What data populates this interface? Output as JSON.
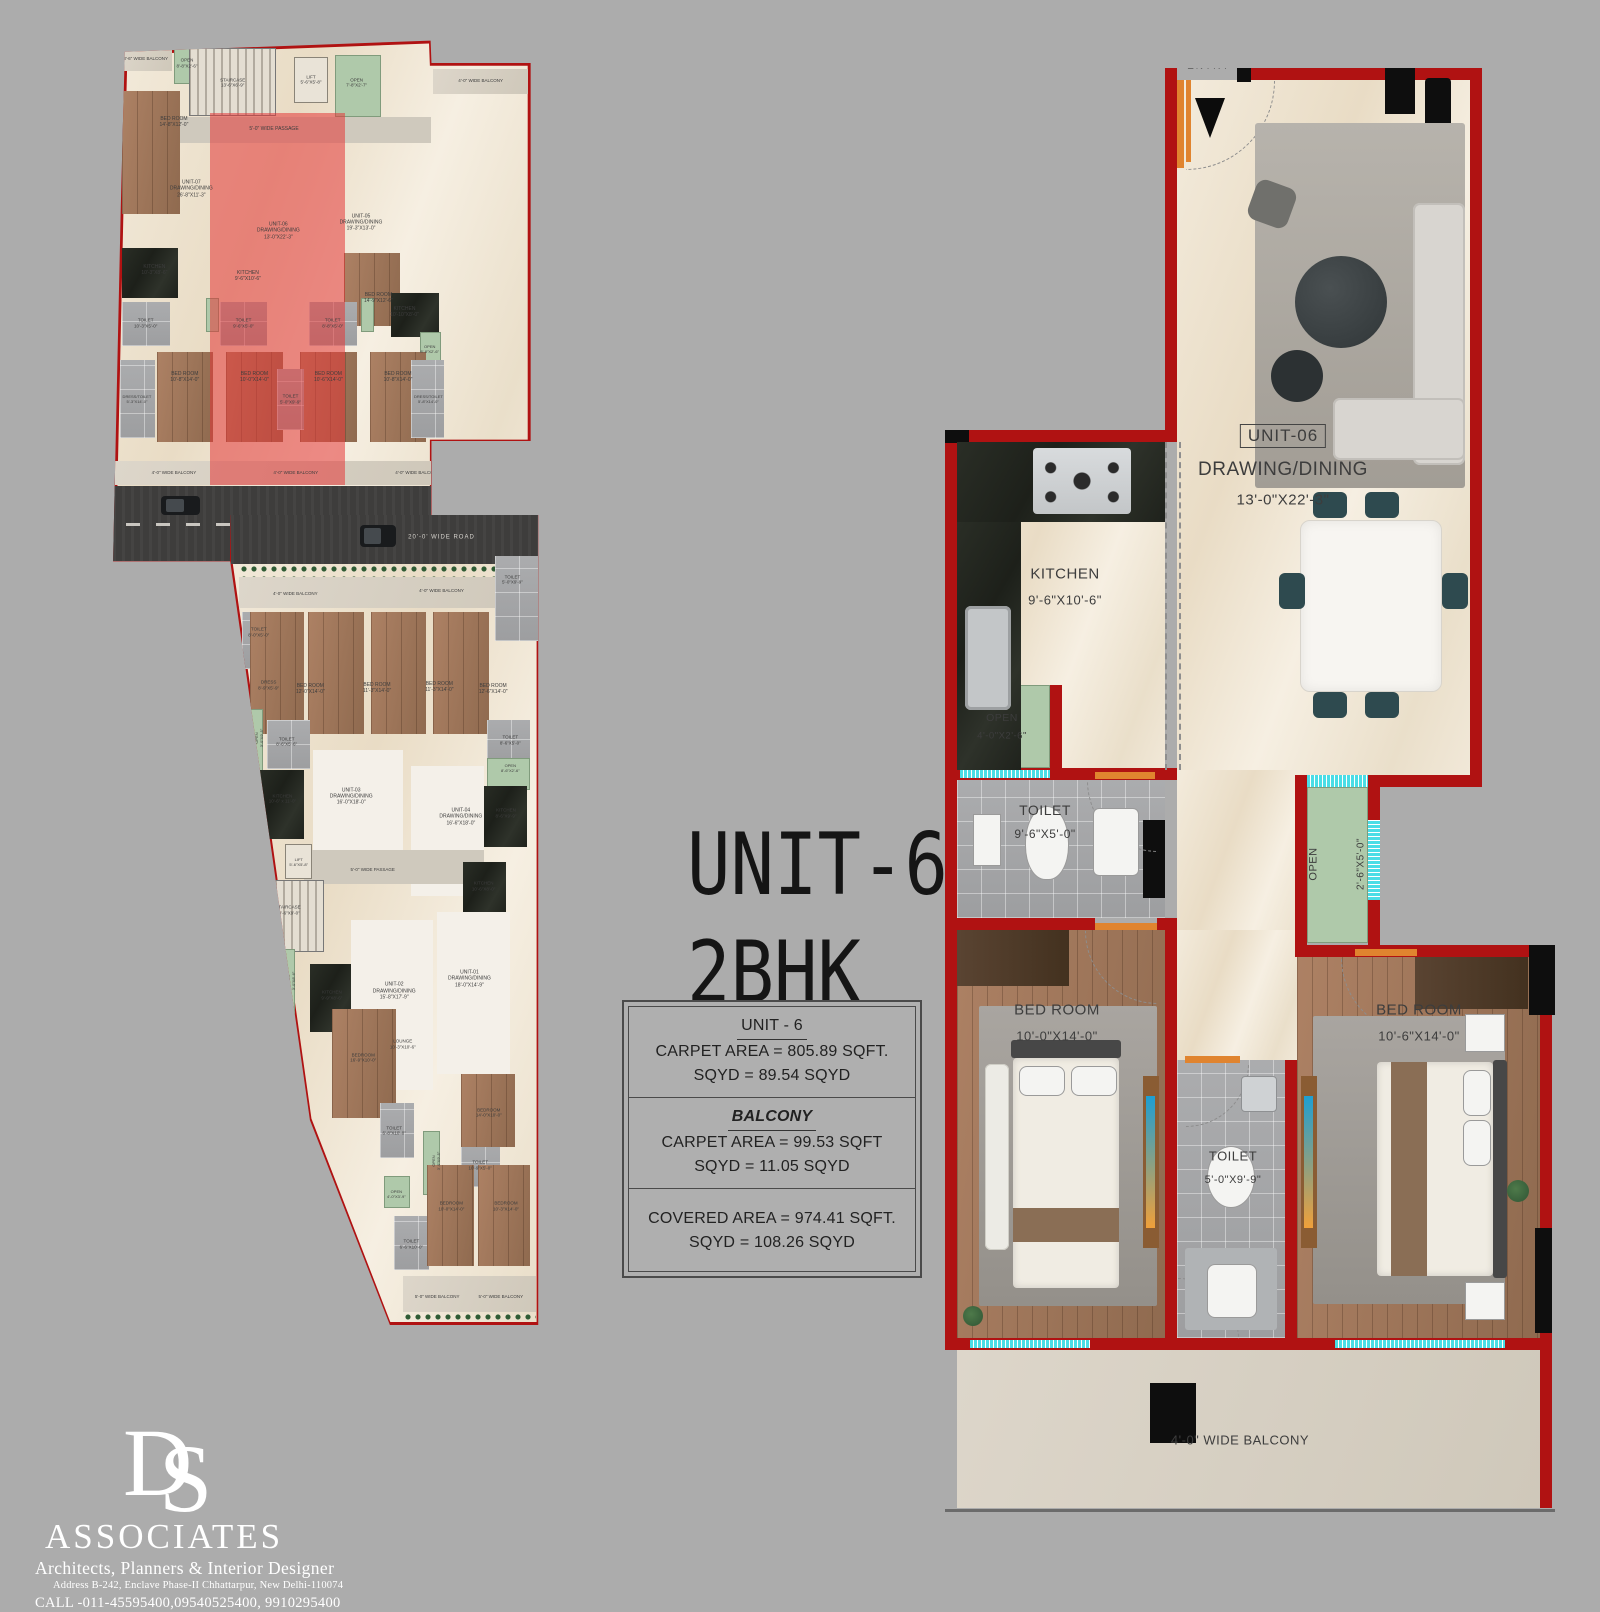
{
  "colors": {
    "background": "#ACACAC",
    "wall_red": "#B01212",
    "floor_cream": "#F0E7D6",
    "floor_white": "#F4F0E9",
    "wood": "#A0755A",
    "dark_wood": "#4E3A2B",
    "tile_gray": "#A8A8AA",
    "open_green": "#AFC9AA",
    "granite_black": "#23261F",
    "window_cyan": "#4ADDE6",
    "door_orange": "#E0842F",
    "road_asphalt": "#3E3D3C",
    "balcony_gray": "#D8D1C5",
    "highlight_red": "rgba(228,54,54,0.55)",
    "label_dark": "#3D3D3D",
    "logo_white": "#FFFFFF"
  },
  "title": {
    "line1": "UNIT-6",
    "line2": "2BHK"
  },
  "info_box": {
    "unit_heading": "UNIT - 6",
    "unit_carpet": "CARPET AREA = 805.89 SQFT.",
    "unit_sqyd": "SQYD = 89.54 SQYD",
    "balcony_heading": "BALCONY",
    "balcony_carpet": "CARPET AREA = 99.53 SQFT",
    "balcony_sqyd": "SQYD = 11.05 SQYD",
    "covered_area": "COVERED AREA = 974.41  SQFT.",
    "covered_sqyd": "SQYD = 108.26 SQYD"
  },
  "unit_plan": {
    "entry": "ENTRY",
    "unit_no": "UNIT-06",
    "drawing": "DRAWING/DINING",
    "drawing_dim": "13'-0\"X22'-3\"",
    "kitchen": "KITCHEN",
    "kitchen_dim": "9'-6\"X10'-6\"",
    "open_a": "OPEN",
    "open_a_dim": "4'-0\"X2'-6\"",
    "toilet_a": "TOILET",
    "toilet_a_dim": "9'-6\"X5'-0\"",
    "open_b": "OPEN",
    "open_b_dim": "2'-6\"X5'-0\"",
    "bed_left": "BED ROOM",
    "bed_left_dim": "10'-0\"X14'-0\"",
    "toilet_b": "TOILET",
    "toilet_b_dim": "5'-0\"X9'-9\"",
    "bed_right": "BED ROOM",
    "bed_right_dim": "10'-6\"X14'-0\"",
    "balcony": "4'-0\" WIDE BALCONY"
  },
  "key_plan_top": {
    "labels": [
      {
        "t": "3'-6\" WIDE BALCONY",
        "x": 10.5,
        "y": 4.3,
        "s": 4.5
      },
      {
        "t": "OPEN\n8'-8\"X2'-6\"",
        "x": 20,
        "y": 5,
        "s": 4.5
      },
      {
        "t": "STAIRCASE\n13'-6\"X6'-9\"",
        "x": 30.5,
        "y": 8.5,
        "s": 4.5
      },
      {
        "t": "LIFT\n5'-6\"X5'-8\"",
        "x": 48.5,
        "y": 8,
        "s": 4.5
      },
      {
        "t": "OPEN\n7'-8\"X2'-7\"",
        "x": 59,
        "y": 8.5,
        "s": 4.5
      },
      {
        "t": "4'-0\" WIDE BALCONY",
        "x": 87.5,
        "y": 8.2,
        "s": 4.5
      },
      {
        "t": "BED ROOM\n14'-8\"X12'-0\"",
        "x": 17,
        "y": 15.5,
        "s": 5
      },
      {
        "t": "5'-0\" WIDE PASSAGE",
        "x": 40,
        "y": 16.7,
        "s": 5
      },
      {
        "t": "BED ROOM\n14'-9\"X12'-6\"",
        "x": 64,
        "y": 47,
        "s": 5
      },
      {
        "t": "UNIT-07\nDRAWING/DINING\n26'-8\"X11'-3\"",
        "x": 21,
        "y": 27.5,
        "s": 5
      },
      {
        "t": "UNIT-06\nDRAWING/DINING\n13'-0\"X22'-3\"",
        "x": 41,
        "y": 35,
        "s": 5
      },
      {
        "t": "UNIT-05\nDRAWING/DINING\n19'-3\"X13'-0\"",
        "x": 60,
        "y": 33.5,
        "s": 5
      },
      {
        "t": "KITCHEN\n10'-3\"X8'-6\"",
        "x": 12.5,
        "y": 42,
        "s": 5
      },
      {
        "t": "KITCHEN\n9'-6\"X10'-6\"",
        "x": 34,
        "y": 43,
        "s": 5
      },
      {
        "t": "KITCHEN\n10'-10\"X8'-0\"",
        "x": 70,
        "y": 49.5,
        "s": 5
      },
      {
        "t": "TOILET\n10'-3\"X5'-0\"",
        "x": 10.5,
        "y": 51.5,
        "s": 4.5
      },
      {
        "t": "TOILET\n9'-6\"X5'-0\"",
        "x": 33,
        "y": 51.5,
        "s": 4.5
      },
      {
        "t": "TOILET\n8'-8\"X5'-0\"",
        "x": 53.5,
        "y": 51.5,
        "s": 4.5
      },
      {
        "t": "OPEN\n8'-8\"X2'-6\"",
        "x": 75.8,
        "y": 56,
        "s": 4
      },
      {
        "t": "BED ROOM\n10'-8\"X14'-0\"",
        "x": 19.5,
        "y": 61,
        "s": 5
      },
      {
        "t": "BED ROOM\n10'-0\"X14'-0\"",
        "x": 35.5,
        "y": 61,
        "s": 5
      },
      {
        "t": "BED ROOM\n10'-6\"X14'-0\"",
        "x": 52.5,
        "y": 61,
        "s": 5
      },
      {
        "t": "BED ROOM\n10'-8\"X14'-0\"",
        "x": 68.5,
        "y": 61,
        "s": 5
      },
      {
        "t": "TOILET\n5'-0\"X9'-9\"",
        "x": 43.8,
        "y": 65,
        "s": 4.5
      },
      {
        "t": "DRESS/TOILET\n5'-3\"X14'-0\"",
        "x": 8.5,
        "y": 65,
        "s": 4
      },
      {
        "t": "DRESS/TOILET\n5'-8\"X14'-0\"",
        "x": 75.5,
        "y": 65,
        "s": 4
      },
      {
        "t": "4'-0\" WIDE BALCONY",
        "x": 17,
        "y": 78.2,
        "s": 4.5
      },
      {
        "t": "4'-0\" WIDE BALCONY",
        "x": 45,
        "y": 78.2,
        "s": 4.5
      },
      {
        "t": "4'-0\" WIDE BALCONY",
        "x": 73,
        "y": 78.2,
        "s": 4.5
      },
      {
        "t": "20'-0' WIDE ROAD",
        "x": 46,
        "y": 87.5,
        "s": 7.5,
        "light": true
      }
    ],
    "patches": [
      {
        "k": "balc",
        "x": 4.5,
        "y": 2.5,
        "w": 12,
        "h": 4
      },
      {
        "k": "green",
        "x": 17,
        "y": 2.2,
        "w": 6,
        "h": 6.5
      },
      {
        "k": "striped",
        "x": 20.5,
        "y": 2.4,
        "w": 20,
        "h": 12
      },
      {
        "k": "lift",
        "x": 44.5,
        "y": 4,
        "w": 8,
        "h": 8.2
      },
      {
        "k": "green",
        "x": 54,
        "y": 3.6,
        "w": 10.5,
        "h": 11
      },
      {
        "k": "balc",
        "x": 76.5,
        "y": 6,
        "w": 22,
        "h": 4.6
      },
      {
        "k": "pass",
        "x": 18,
        "y": 14.6,
        "w": 58,
        "h": 4.6
      },
      {
        "k": "wood",
        "x": 5,
        "y": 10,
        "w": 13.5,
        "h": 22
      },
      {
        "k": "wood",
        "x": 56,
        "y": 39,
        "w": 13,
        "h": 13
      },
      {
        "k": "granite",
        "x": 5,
        "y": 38,
        "w": 13,
        "h": 9
      },
      {
        "k": "granite",
        "x": 67,
        "y": 46,
        "w": 11,
        "h": 8
      },
      {
        "k": "tile",
        "x": 5,
        "y": 47.6,
        "w": 11,
        "h": 8
      },
      {
        "k": "tile",
        "x": 27.5,
        "y": 47.6,
        "w": 11,
        "h": 8
      },
      {
        "k": "tile",
        "x": 48,
        "y": 47.6,
        "w": 11,
        "h": 8
      },
      {
        "k": "green",
        "x": 24.4,
        "y": 47,
        "w": 3,
        "h": 6
      },
      {
        "k": "green",
        "x": 60,
        "y": 47,
        "w": 3,
        "h": 6
      },
      {
        "k": "green",
        "x": 73.5,
        "y": 53,
        "w": 5,
        "h": 7
      },
      {
        "k": "wood",
        "x": 13,
        "y": 56.6,
        "w": 13,
        "h": 16
      },
      {
        "k": "wood",
        "x": 29,
        "y": 56.6,
        "w": 13,
        "h": 16
      },
      {
        "k": "wood",
        "x": 46,
        "y": 56.6,
        "w": 13,
        "h": 16
      },
      {
        "k": "wood",
        "x": 62,
        "y": 56.6,
        "w": 13,
        "h": 16
      },
      {
        "k": "tile",
        "x": 40.6,
        "y": 59.6,
        "w": 6.4,
        "h": 11
      },
      {
        "k": "tile",
        "x": 4.6,
        "y": 58,
        "w": 8,
        "h": 14
      },
      {
        "k": "tile",
        "x": 71.5,
        "y": 58,
        "w": 7.5,
        "h": 14
      },
      {
        "k": "balc",
        "x": 3.5,
        "y": 76,
        "w": 72.5,
        "h": 4.4
      },
      {
        "k": "road",
        "x": 3,
        "y": 80.6,
        "w": 73.2,
        "h": 13.4
      },
      {
        "k": "roadline",
        "x": 6,
        "y": 87.2,
        "w": 68,
        "h": 0.5
      },
      {
        "k": "car",
        "x": 14,
        "y": 82.3,
        "w": 9,
        "h": 3.4
      },
      {
        "k": "redov",
        "x": 25.3,
        "y": 14,
        "w": 31,
        "h": 66.4
      }
    ]
  },
  "key_plan_bottom": {
    "labels": [
      {
        "t": "20'-0' WIDE ROAD",
        "x": 55,
        "y": 2.8,
        "s": 6,
        "light": true
      },
      {
        "t": "4'-0\" WIDE BALCONY",
        "x": 21,
        "y": 9.7,
        "s": 4.5
      },
      {
        "t": "4'-0\" WIDE BALCONY",
        "x": 55,
        "y": 9.4,
        "s": 4.5
      },
      {
        "t": "TOILET\n5'-0\"X9'-9\"",
        "x": 71.5,
        "y": 8,
        "s": 4.5
      },
      {
        "t": "TOILET\n8'-0\"X5'-0\"",
        "x": 12.5,
        "y": 14.5,
        "s": 4.5
      },
      {
        "t": "DRESS\n8'-9\"X5'-9\"",
        "x": 14.8,
        "y": 21,
        "s": 4.5
      },
      {
        "t": "BED ROOM\n12'-0\"X14'-0\"",
        "x": 24.5,
        "y": 21.5,
        "s": 5
      },
      {
        "t": "BED ROOM\n11'-3\"X14'-0\"",
        "x": 40,
        "y": 21.3,
        "s": 5
      },
      {
        "t": "BED ROOM\n11'-3\"X14'-0\"",
        "x": 54.5,
        "y": 21.2,
        "s": 5
      },
      {
        "t": "BED ROOM\n12'-6\"X14'-0\"",
        "x": 67,
        "y": 21.5,
        "s": 5
      },
      {
        "t": "TOILET\n8'-6\"X5'-6\"",
        "x": 19,
        "y": 28,
        "s": 4.5
      },
      {
        "t": "TOILET\n8'-6\"X5'-0\"",
        "x": 71,
        "y": 27.8,
        "s": 4.5
      },
      {
        "t": "OPEN\n3'-0\"X9'-5\"",
        "x": 12.5,
        "y": 27.5,
        "s": 4,
        "r": 90
      },
      {
        "t": "OPEN\n8'-6\"X2'-6\"",
        "x": 71,
        "y": 31.2,
        "s": 4
      },
      {
        "t": "KITCHEN\n10'-6\" x 11'-0\"",
        "x": 18,
        "y": 35,
        "s": 4.5
      },
      {
        "t": "UNIT-03\nDRAWING/DINING\n16'-0\"X18'-0\"",
        "x": 34,
        "y": 34.8,
        "s": 5
      },
      {
        "t": "UNIT-04\nDRAWING/DINING\n16'-6\"X18'-0\"",
        "x": 59.5,
        "y": 37.3,
        "s": 5
      },
      {
        "t": "KITCHEN\n8'-6\"X9'-9\"",
        "x": 70,
        "y": 36.8,
        "s": 4.5
      },
      {
        "t": "LIFT\n5'-6\"X5'-8\"",
        "x": 21.8,
        "y": 42.8,
        "s": 4
      },
      {
        "t": "5'-0\" WIDE PASSAGE",
        "x": 39,
        "y": 43.8,
        "s": 4.5
      },
      {
        "t": "KITCHEN\n10'-6\"X8'-0\"",
        "x": 64.8,
        "y": 45.8,
        "s": 4.5
      },
      {
        "t": "STAIRCASE\n14'-6\"X9'-0\"",
        "x": 19.3,
        "y": 48.8,
        "s": 4.5
      },
      {
        "t": "OPEN\n3'-0\"X8'-6\"",
        "x": 20,
        "y": 57.5,
        "s": 4,
        "r": 90
      },
      {
        "t": "KITCHEN\n9'-9\"X8'-6\"",
        "x": 29.5,
        "y": 59.3,
        "s": 4.5
      },
      {
        "t": "UNIT-02\nDRAWING/DINING\n15'-8\"X17'-9\"",
        "x": 44,
        "y": 58.8,
        "s": 5
      },
      {
        "t": "UNIT-01\nDRAWING/DINING\n18'-0\"X14'-9\"",
        "x": 61.5,
        "y": 57.3,
        "s": 5
      },
      {
        "t": "LOUNGE\n10'-3\"X10'-6\"",
        "x": 46,
        "y": 65.3,
        "s": 4.5
      },
      {
        "t": "BEDROOM\n16'-9\"X10'-0\"",
        "x": 36.8,
        "y": 67,
        "s": 4.5
      },
      {
        "t": "BEDROOM\n14'-0\"X10'-0\"",
        "x": 66,
        "y": 73.8,
        "s": 4.5
      },
      {
        "t": "TOILET\n6'-8\"X10'-0\"",
        "x": 44,
        "y": 76,
        "s": 4.5
      },
      {
        "t": "OPEN\n3'-0\"X9'-5\"",
        "x": 53.8,
        "y": 79.8,
        "s": 4,
        "r": 90
      },
      {
        "t": "TOILET\n10'-9\"X5'-0\"",
        "x": 64,
        "y": 80.3,
        "s": 4.5
      },
      {
        "t": "OPEN\n4'-0\"X3'-9\"",
        "x": 44.5,
        "y": 83.8,
        "s": 4
      },
      {
        "t": "TOILET\n6'-6\"X10'-0\"",
        "x": 48,
        "y": 90,
        "s": 4.5
      },
      {
        "t": "BEDROOM\n10'-0\"X14'-0\"",
        "x": 57.3,
        "y": 85.3,
        "s": 4.5
      },
      {
        "t": "BEDROOM\n10'-3\"X14'-0\"",
        "x": 70,
        "y": 85.3,
        "s": 4.5
      },
      {
        "t": "5'-0\" WIDE BALCONY",
        "x": 54,
        "y": 96.5,
        "s": 4.5
      },
      {
        "t": "5'-0\" WIDE BALCONY",
        "x": 68.8,
        "y": 96.5,
        "s": 4.5
      }
    ],
    "patches": [
      {
        "k": "road",
        "x": 6,
        "y": 0,
        "w": 71.5,
        "h": 6
      },
      {
        "k": "car",
        "x": 36,
        "y": 1.2,
        "w": 8.5,
        "h": 2.8
      },
      {
        "k": "hedge",
        "x": 8,
        "y": 6.1,
        "w": 69,
        "h": 1.5
      },
      {
        "k": "balc",
        "x": 8,
        "y": 7.7,
        "w": 69,
        "h": 3.8
      },
      {
        "k": "tile",
        "x": 67.5,
        "y": 5,
        "w": 10,
        "h": 10.5
      },
      {
        "k": "tile",
        "x": 8.5,
        "y": 12,
        "w": 9,
        "h": 7
      },
      {
        "k": "tile",
        "x": 11,
        "y": 18.8,
        "w": 7,
        "h": 5
      },
      {
        "k": "wood",
        "x": 10.5,
        "y": 12,
        "w": 12.5,
        "h": 15
      },
      {
        "k": "wood",
        "x": 24,
        "y": 12,
        "w": 13,
        "h": 15
      },
      {
        "k": "wood",
        "x": 38.5,
        "y": 12,
        "w": 13,
        "h": 15
      },
      {
        "k": "wood",
        "x": 53,
        "y": 12,
        "w": 13,
        "h": 15
      },
      {
        "k": "tile",
        "x": 14.5,
        "y": 25.3,
        "w": 10,
        "h": 6
      },
      {
        "k": "tile",
        "x": 65.5,
        "y": 25.3,
        "w": 10,
        "h": 5.5
      },
      {
        "k": "green",
        "x": 9,
        "y": 24,
        "w": 4.5,
        "h": 9
      },
      {
        "k": "green",
        "x": 65.5,
        "y": 30,
        "w": 10,
        "h": 4
      },
      {
        "k": "granite",
        "x": 12,
        "y": 31.5,
        "w": 11,
        "h": 8.5
      },
      {
        "k": "granite",
        "x": 64,
        "y": 33.5,
        "w": 11,
        "h": 7.5
      },
      {
        "k": "white",
        "x": 25,
        "y": 29,
        "w": 21,
        "h": 16.5
      },
      {
        "k": "white",
        "x": 48,
        "y": 31,
        "w": 17,
        "h": 16
      },
      {
        "k": "pass",
        "x": 23,
        "y": 41.3,
        "w": 42,
        "h": 4.3
      },
      {
        "k": "lift",
        "x": 18.6,
        "y": 40.6,
        "w": 6.4,
        "h": 4.4
      },
      {
        "k": "granite",
        "x": 60,
        "y": 42.8,
        "w": 10,
        "h": 6.6
      },
      {
        "k": "striped",
        "x": 12.6,
        "y": 45,
        "w": 15,
        "h": 9
      },
      {
        "k": "green",
        "x": 16.5,
        "y": 53.6,
        "w": 4.4,
        "h": 9.8
      },
      {
        "k": "granite",
        "x": 24.4,
        "y": 55.4,
        "w": 10,
        "h": 8.4
      },
      {
        "k": "white",
        "x": 34,
        "y": 50,
        "w": 19,
        "h": 21
      },
      {
        "k": "white",
        "x": 54,
        "y": 49,
        "w": 17,
        "h": 20
      },
      {
        "k": "wood",
        "x": 29.5,
        "y": 61,
        "w": 15,
        "h": 13.4
      },
      {
        "k": "tile",
        "x": 40.6,
        "y": 72.6,
        "w": 8,
        "h": 6.8
      },
      {
        "k": "green",
        "x": 50.6,
        "y": 76,
        "w": 4,
        "h": 8
      },
      {
        "k": "tile",
        "x": 59.6,
        "y": 77,
        "w": 9,
        "h": 6
      },
      {
        "k": "green",
        "x": 41.6,
        "y": 81.6,
        "w": 6,
        "h": 4
      },
      {
        "k": "tile",
        "x": 44,
        "y": 86.6,
        "w": 8,
        "h": 6.6
      },
      {
        "k": "wood",
        "x": 59.6,
        "y": 69,
        "w": 12.4,
        "h": 9
      },
      {
        "k": "wood",
        "x": 51.6,
        "y": 80.3,
        "w": 11,
        "h": 12.4
      },
      {
        "k": "wood",
        "x": 63.6,
        "y": 80.3,
        "w": 12,
        "h": 12.4
      },
      {
        "k": "balc",
        "x": 46,
        "y": 94,
        "w": 31,
        "h": 4.4
      },
      {
        "k": "hedge",
        "x": 46,
        "y": 98.4,
        "w": 31,
        "h": 1.5
      }
    ]
  },
  "logo": {
    "monogram_d": "D",
    "monogram_s": "S",
    "name": "ASSOCIATES",
    "tagline": "Architects, Planners & Interior Designer",
    "address": "Address B-242, Enclave Phase-II Chhattarpur, New Delhi-110074",
    "call": "CALL -011-45595400,09540525400, 9910295400"
  }
}
